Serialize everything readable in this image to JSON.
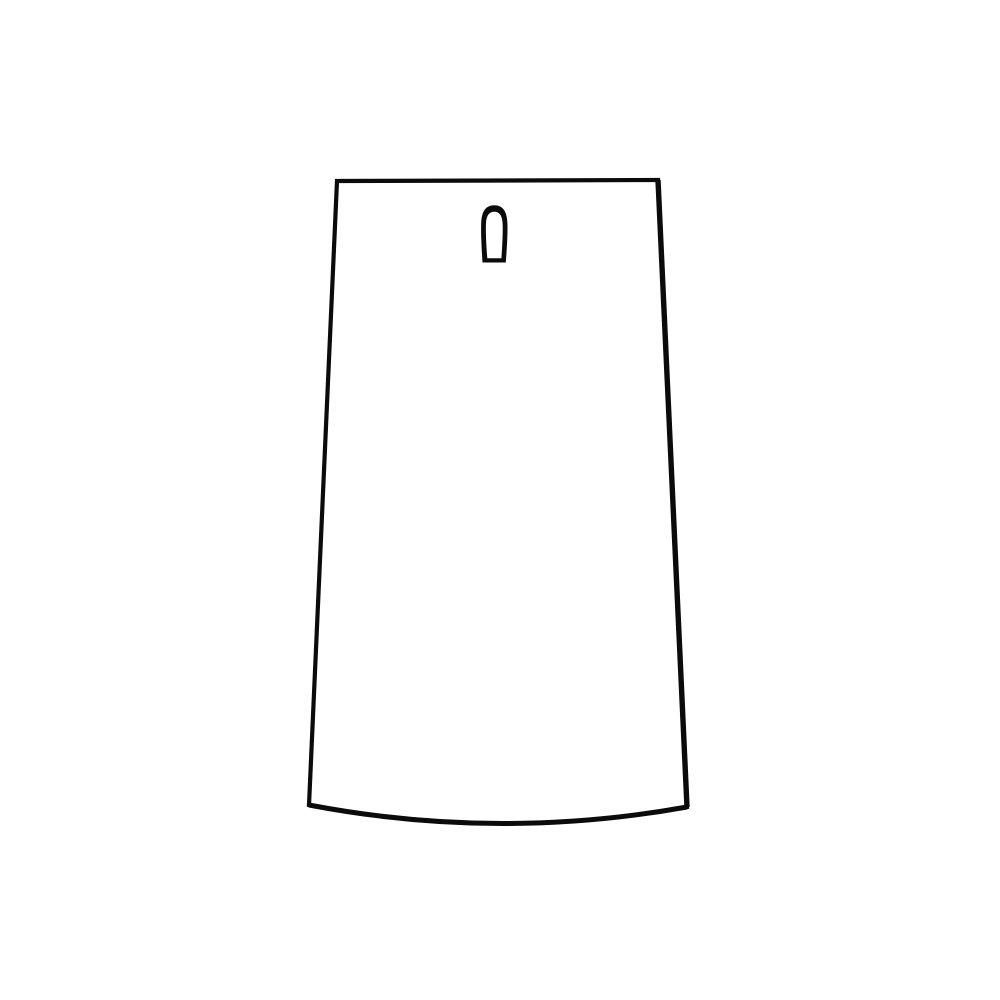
{
  "canvas": {
    "background_color": "#ffffff",
    "width": 1000,
    "height": 1000
  },
  "illustration": {
    "description": "Blank trapezoidal hang tag line drawing: narrow flat top, sides flaring slightly outward, curved bottom hem bowing downward, and a keyhole-style hanging hole near the top center",
    "stroke_color": "#0b0b0b",
    "body_fill_color": "#ffffff",
    "outline_path": "M 337 181 L 658 180 L 687 807 Q 498 841 309 805 Z",
    "right_edge_path": "M 658 180 L 687 807",
    "bottom_hem_path": "M 687 807 Q 498 841 309 805",
    "hang_hole_path": "M 482.5 262.5 C 481.5 247 480.8 232 481.2 223 C 481.7 211 486 205.3 494.3 205.3 C 502.6 205.3 506.9 211 507.4 223 C 507.8 232 507 247 505.8 262.5 Z M 487.3 258.2 C 486.2 245 485.6 231 486 223.5 C 486.4 215 489.6 211.8 494.3 211.8 C 499 211.8 502.2 215 502.6 223.5 C 503 231 502.4 245 501.4 258.2 Z"
  }
}
